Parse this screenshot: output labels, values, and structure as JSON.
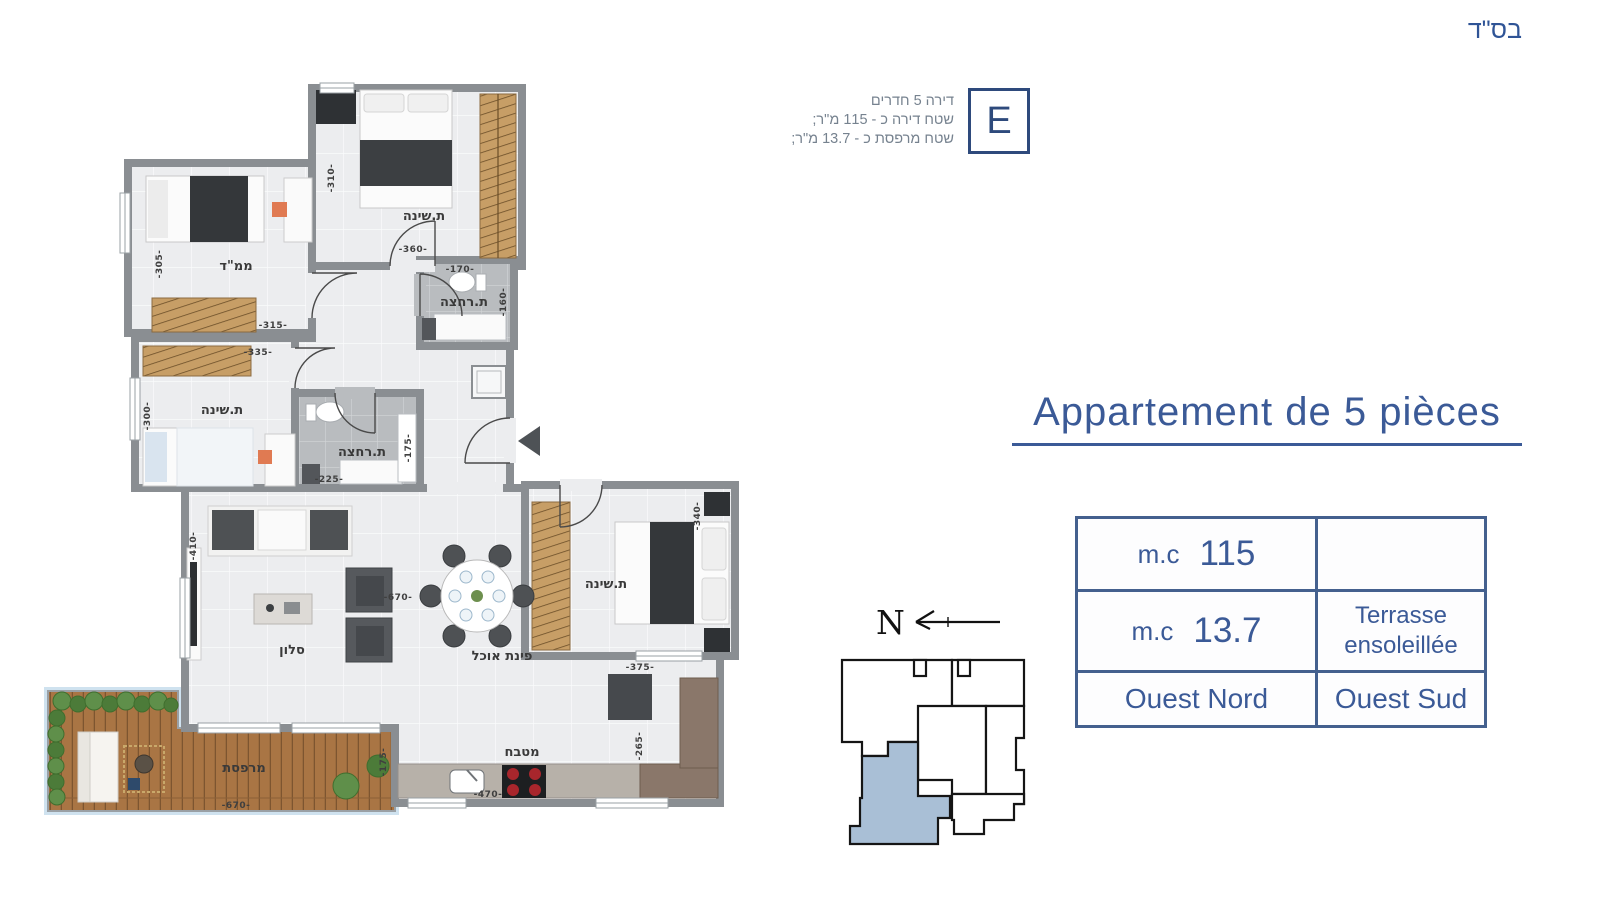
{
  "header": {
    "bsd": "בס\"ד"
  },
  "unit_info": {
    "letter": "E",
    "line1": "דירה 5 חדרים",
    "line2": "שטח דירה כ - 115 מ\"ר;",
    "line3": "שטח מרפסת כ - 13.7 מ\"ר;"
  },
  "title": "Appartement de 5 pièces",
  "spec_table": {
    "r1c1_unit": "m.c",
    "r1c1_value": "115",
    "r1c2": "",
    "r2c1_unit": "m.c",
    "r2c1_value": "13.7",
    "r2c2_line1": "Terrasse",
    "r2c2_line2": "ensoleillée",
    "r3c1": "Ouest Nord",
    "r3c2": "Ouest Sud"
  },
  "compass": {
    "north_label": "N"
  },
  "colors": {
    "accent_blue": "#3b5a97",
    "navy_border": "#2e4a7c",
    "info_gray": "#76828f",
    "highlighted_unit": "#a9bfd6",
    "wall_gray": "#8a8e92"
  },
  "floor_plan": {
    "rooms": {
      "bedroom_top": "ת.שינה",
      "mamad": "ממ\"ד",
      "bath_top": "ת.רחצה",
      "bedroom_left": "ת.שינה",
      "bath_mid": "ת.רחצה",
      "salon": "סלון",
      "dining": "פינת אוכל",
      "bedroom_right": "ת.שינה",
      "kitchen": "מטבח",
      "terrace": "מרפסת"
    },
    "dims": {
      "bedroom_top_w": "-360-",
      "bedroom_top_h": "-310-",
      "mamad_w": "-315-",
      "mamad_h": "-305-",
      "bath_top_w": "-170-",
      "bath_top_h": "-160-",
      "bedroom_left_w": "-335-",
      "bedroom_left_h": "-300-",
      "bath_mid_w": "-225-",
      "bath_mid_h": "-175-",
      "living_w": "-670-",
      "living_h": "-410-",
      "bedroom_right_w": "-375-",
      "bedroom_right_h": "-340-",
      "kitchen_w": "-470-",
      "kitchen_h": "-265-",
      "terrace_w": "-670-",
      "terrace_h": "-175-"
    }
  }
}
